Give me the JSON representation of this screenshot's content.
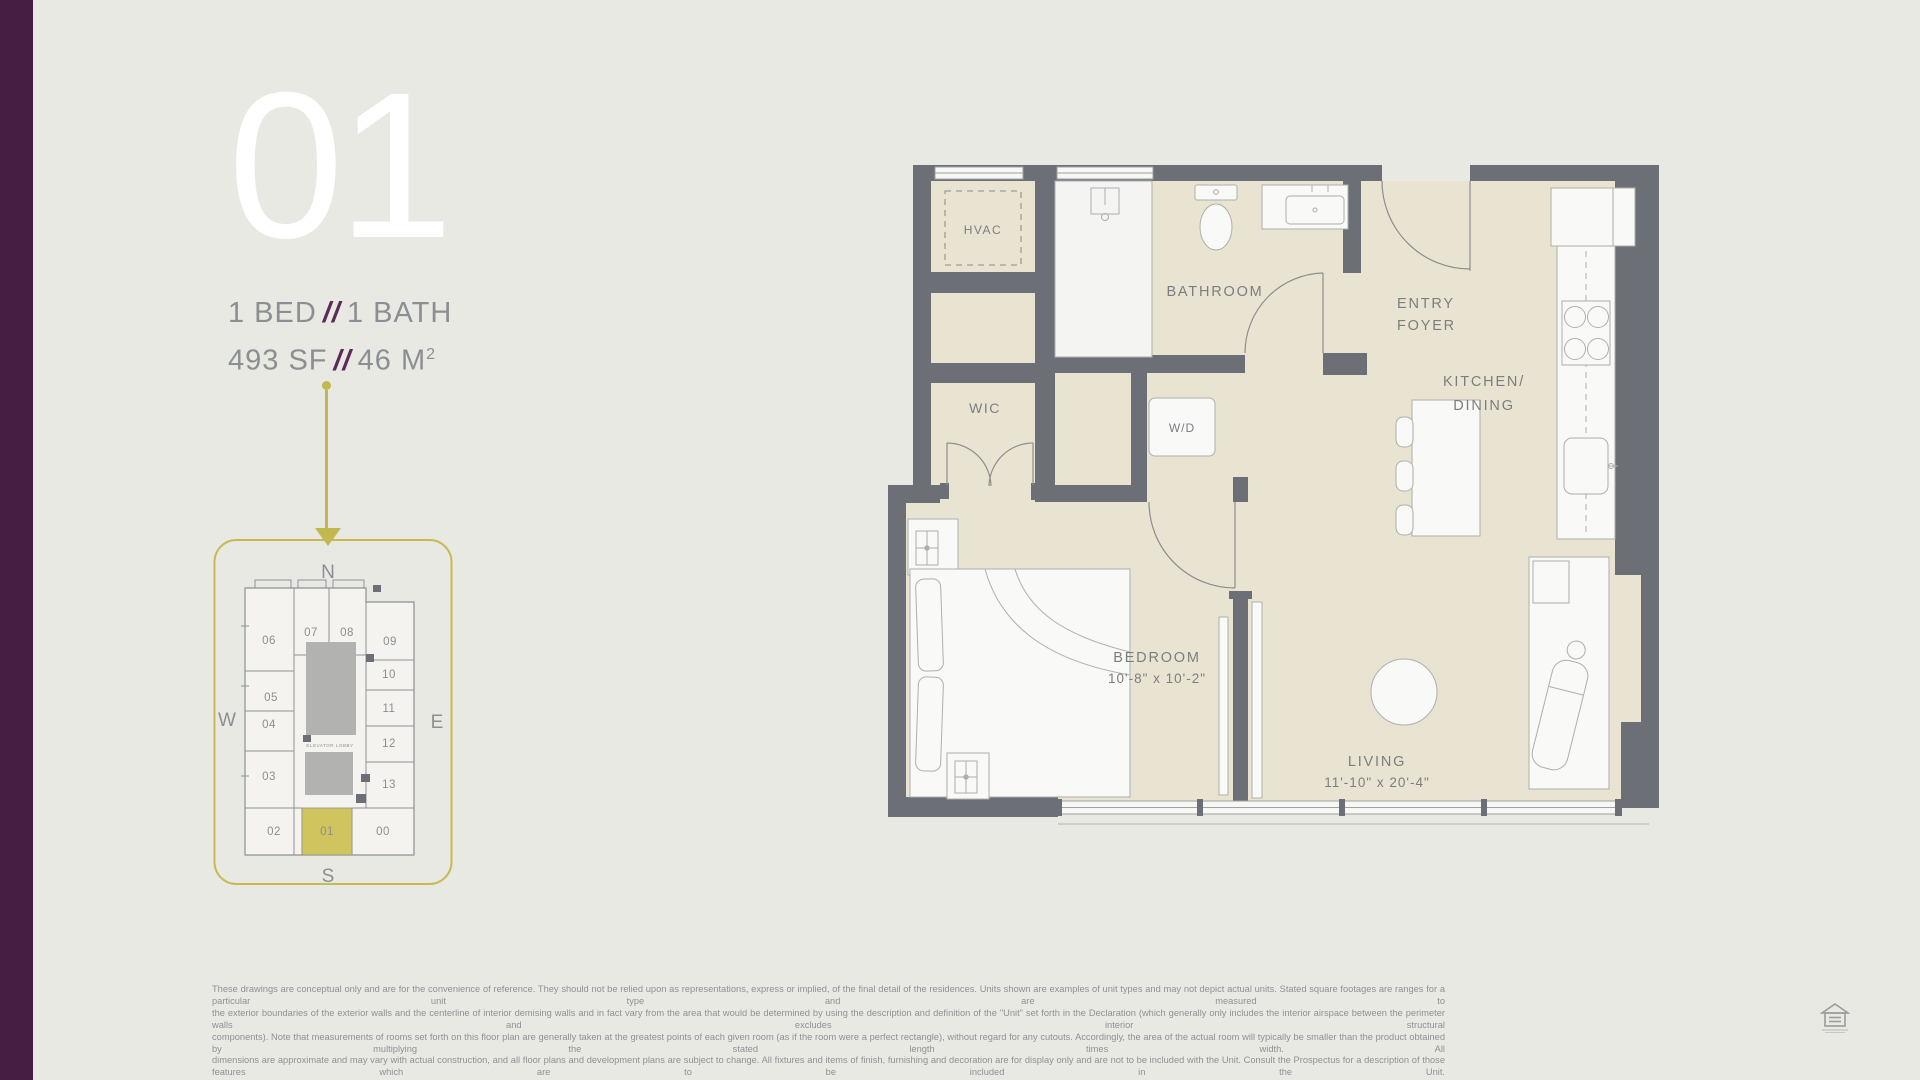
{
  "page": {
    "background": "#e9e9e4",
    "sidebar_purple": "#461e43",
    "accent_purple": "#5b2a57",
    "keyplan_olive": "#c6bb52",
    "wall_gray": "#6c7076",
    "floor_cream": "#e9e4d2"
  },
  "header": {
    "unit_number": "01",
    "spec_line1": {
      "left": "1 BED",
      "sep": "//",
      "right": "1 BATH"
    },
    "spec_line2": {
      "left": "493 SF",
      "sep": "//",
      "right_base": "46 M",
      "right_sup": "2"
    }
  },
  "keyplan": {
    "compass": {
      "north": "N",
      "south": "S",
      "east": "E",
      "west": "W"
    },
    "elevator_label": "ELEVATOR LOBBY",
    "highlighted_unit": "01",
    "units": [
      "06",
      "07",
      "08",
      "09",
      "05",
      "10",
      "11",
      "04",
      "12",
      "03",
      "13",
      "02",
      "01",
      "00"
    ]
  },
  "floorplan": {
    "rooms": {
      "hvac": "HVAC",
      "wic": "WIC",
      "bathroom": "BATHROOM",
      "entry_line1": "ENTRY",
      "entry_line2": "FOYER",
      "kitchen_line1": "KITCHEN/",
      "kitchen_line2": "DINING",
      "wd": "W/D",
      "bedroom": "BEDROOM",
      "bedroom_dims": "10'-8\" x 10'-2\"",
      "living": "LIVING",
      "living_dims": "11'-10\" x 20'-4\""
    }
  },
  "disclaimer": {
    "lines": [
      "These drawings are conceptual only and are for the convenience of reference. They should not be relied upon as representations, express or implied, of the final detail of the residences. Units shown are examples of unit types and may not depict actual units. Stated square footages are ranges for a particular unit type and are measured to",
      "the exterior boundaries of the exterior walls and the centerline of interior demising walls and in fact vary from the area that would be determined by using the description and definition of the \"Unit\" set forth in the Declaration (which generally only includes the interior airspace between the perimeter walls and excludes interior structural",
      "components). Note that measurements of rooms set forth on this floor plan are generally taken at the greatest points of each given room (as if the room were a perfect rectangle), without regard for any cutouts. Accordingly, the area of the actual room will typically be smaller than the product obtained by multiplying the stated length times width. All",
      "dimensions are approximate and may vary with actual construction, and all floor plans and development plans are subject to change. All fixtures and items of finish, furnishing and decoration are for display only and are not to be included with the Unit. Consult the Prospectus for a description of those features which are to be included in the Unit."
    ]
  },
  "footer": {
    "logo": "equal-housing-logo"
  }
}
